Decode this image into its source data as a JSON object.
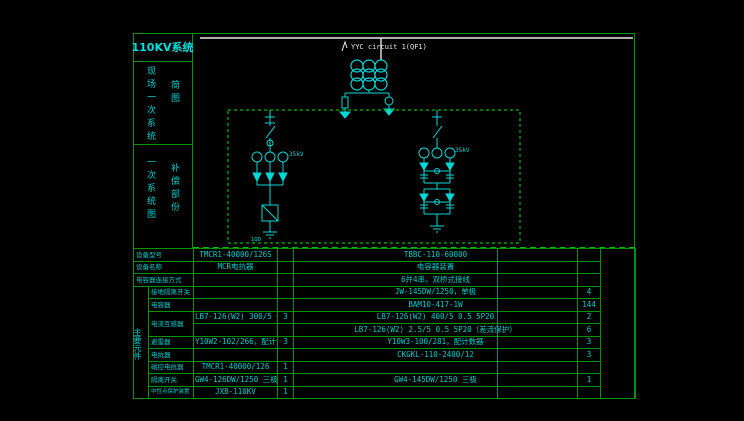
{
  "colors": {
    "background": "#000000",
    "grid_green": "#009500",
    "dashed_green": "#00bb00",
    "cad_cyan": "#00cdcd",
    "bus_white": "#e8e8e8"
  },
  "sidebar": {
    "title": "110KV系统",
    "section1": {
      "col1": "现场一次系统",
      "col2": "简图"
    },
    "section2": {
      "col1": "一次系统图",
      "col2": "补偿部份"
    }
  },
  "diagram": {
    "circuit_label": "YYC circuit 1(QF1)",
    "left_branch_voltage": "35kV",
    "right_branch_voltage": "35kV",
    "ground_switch_label": "1QD"
  },
  "table": {
    "group_label": "主要元件",
    "rows": [
      {
        "label": "设备型号",
        "lv": "TMCR1-40000/126S",
        "lq": "",
        "rv": "TBBC-110-60000",
        "rq": ""
      },
      {
        "label": "设备名称",
        "lv": "MCR电抗器",
        "lq": "",
        "rv": "电容器装置",
        "rq": ""
      },
      {
        "label": "电容器连接方式",
        "lv": "",
        "lq": "",
        "rv": "6并4串，双桥式接线",
        "rq": ""
      },
      {
        "label": "接地隔离开关",
        "lv": "",
        "lq": "",
        "rv": "JW-145DW/1250，单极",
        "rq": "4"
      },
      {
        "label": "电容器",
        "lv": "",
        "lq": "",
        "rv": "BAM10-417-1W",
        "rq": "144"
      },
      {
        "label": "电流互感器",
        "lv": "LB7-126(W2) 300/5 0.5 5P20",
        "lq": "3",
        "rv": "LB7-126(W2) 400/5 0.5 5P20",
        "rq": "2"
      },
      {
        "label": "",
        "lv": "",
        "lq": "",
        "rv": "LB7-126(W2) 2.5/5 0.5 5P20（差流保护）",
        "rq": "6"
      },
      {
        "label": "避雷器",
        "lv": "Y10W2-102/266，配计数器",
        "lq": "3",
        "rv": "Y10W3-100/281，配计数器",
        "rq": "3"
      },
      {
        "label": "电抗器",
        "lv": "",
        "lq": "",
        "rv": "CKGKL-110-2400/12",
        "rq": "3"
      },
      {
        "label": "磁控电抗器",
        "lv": "TMCR1-40000/126",
        "lq": "1",
        "rv": "",
        "rq": ""
      },
      {
        "label": "隔离开关",
        "lv": "GW4-126DW/1250 三极",
        "lq": "1",
        "rv": "GW4-145DW/1250 三极",
        "rq": "1"
      },
      {
        "label": "中性点保护装置",
        "lv": "JXB-110KV",
        "lq": "1",
        "rv": "",
        "rq": ""
      }
    ]
  }
}
